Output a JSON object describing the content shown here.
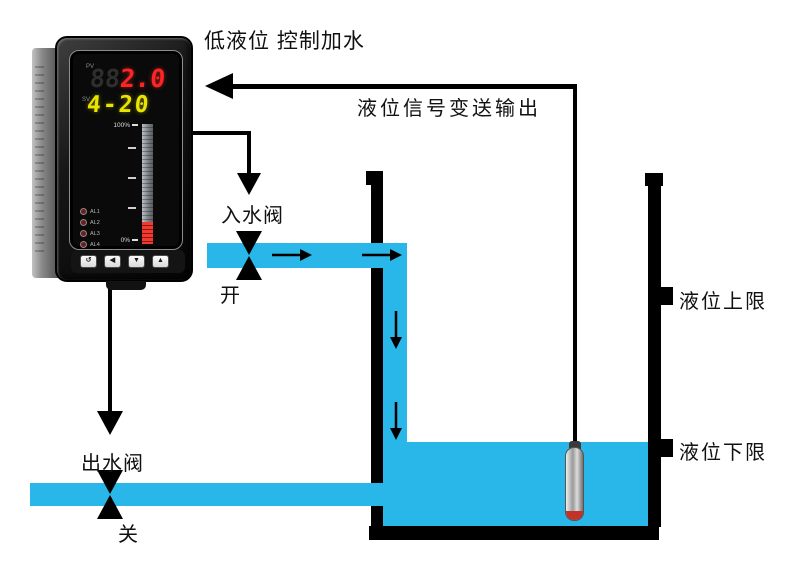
{
  "title": "低液位 控制加水",
  "signal_line_label": "液位信号变送输出",
  "inlet_valve": {
    "label": "入水阀",
    "state": "开"
  },
  "outlet_valve": {
    "label": "出水阀",
    "state": "关"
  },
  "tank": {
    "upper_limit_label": "液位上限",
    "lower_limit_label": "液位下限"
  },
  "controller": {
    "pv_label": "PV",
    "pv_ghost_digits": "88",
    "pv_value": "2.0",
    "sv_label": "SV",
    "sv_value": "4-20",
    "bargraph_top_label": "100%",
    "bargraph_bottom_label": "0%",
    "alarm_leds": [
      "AL1",
      "AL2",
      "AL3",
      "AL4"
    ],
    "buttons": [
      "↺",
      "◀",
      "▼",
      "▲"
    ]
  },
  "colors": {
    "water": "#29b6e8",
    "pv_display_red": "#ff2424",
    "sv_display_yellow": "#e8e400",
    "line_black": "#000000",
    "probe_tip_red": "#c13327"
  }
}
